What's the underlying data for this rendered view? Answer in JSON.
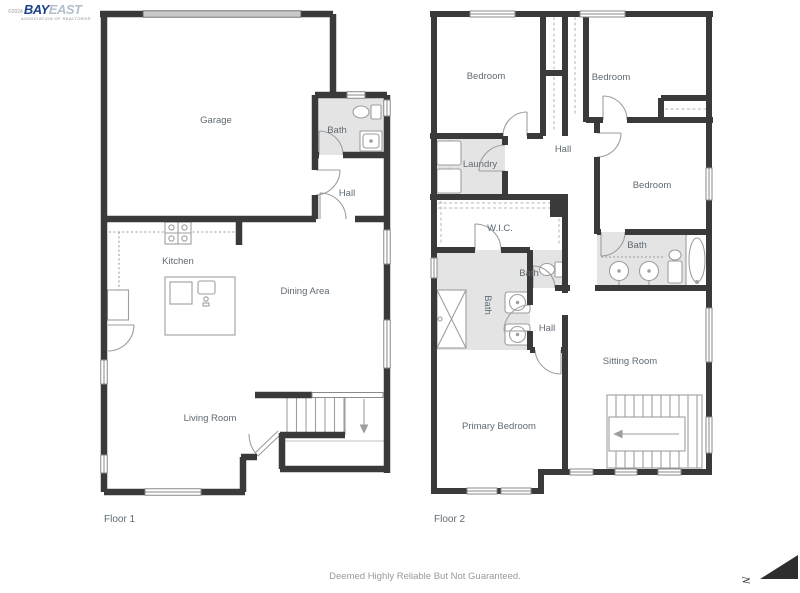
{
  "logo": {
    "copyright": "©2024",
    "brand_primary": "BAY",
    "brand_secondary": "EAST",
    "tagline": "ASSOCIATION OF REALTORS®"
  },
  "floor1": {
    "caption": "Floor 1",
    "rooms": {
      "garage": "Garage",
      "bath": "Bath",
      "hall": "Hall",
      "kitchen": "Kitchen",
      "dining_area": "Dining Area",
      "living_room": "Living Room"
    }
  },
  "floor2": {
    "caption": "Floor 2",
    "rooms": {
      "bedroom_top_left": "Bedroom",
      "bedroom_top_right": "Bedroom",
      "bedroom_right": "Bedroom",
      "laundry": "Laundry",
      "hall_upper": "Hall",
      "wic": "W.I.C.",
      "bath_small": "Bath",
      "bath_primary": "Bath",
      "bath_right": "Bath",
      "hall_lower": "Hall",
      "sitting_room": "Sitting Room",
      "primary_bedroom": "Primary Bedroom"
    }
  },
  "footer": {
    "disclaimer": "Deemed Highly Reliable But Not Guaranteed."
  },
  "compass": {
    "letter": "N"
  },
  "colors": {
    "wall": "#3a3a3a",
    "room_fill": "#e4e4e4",
    "fixture_line": "#9e9e9e",
    "label": "#5f6a72",
    "brand_blue": "#1b4189",
    "brand_light": "#b3bfca",
    "muted": "#9a9a9a"
  }
}
